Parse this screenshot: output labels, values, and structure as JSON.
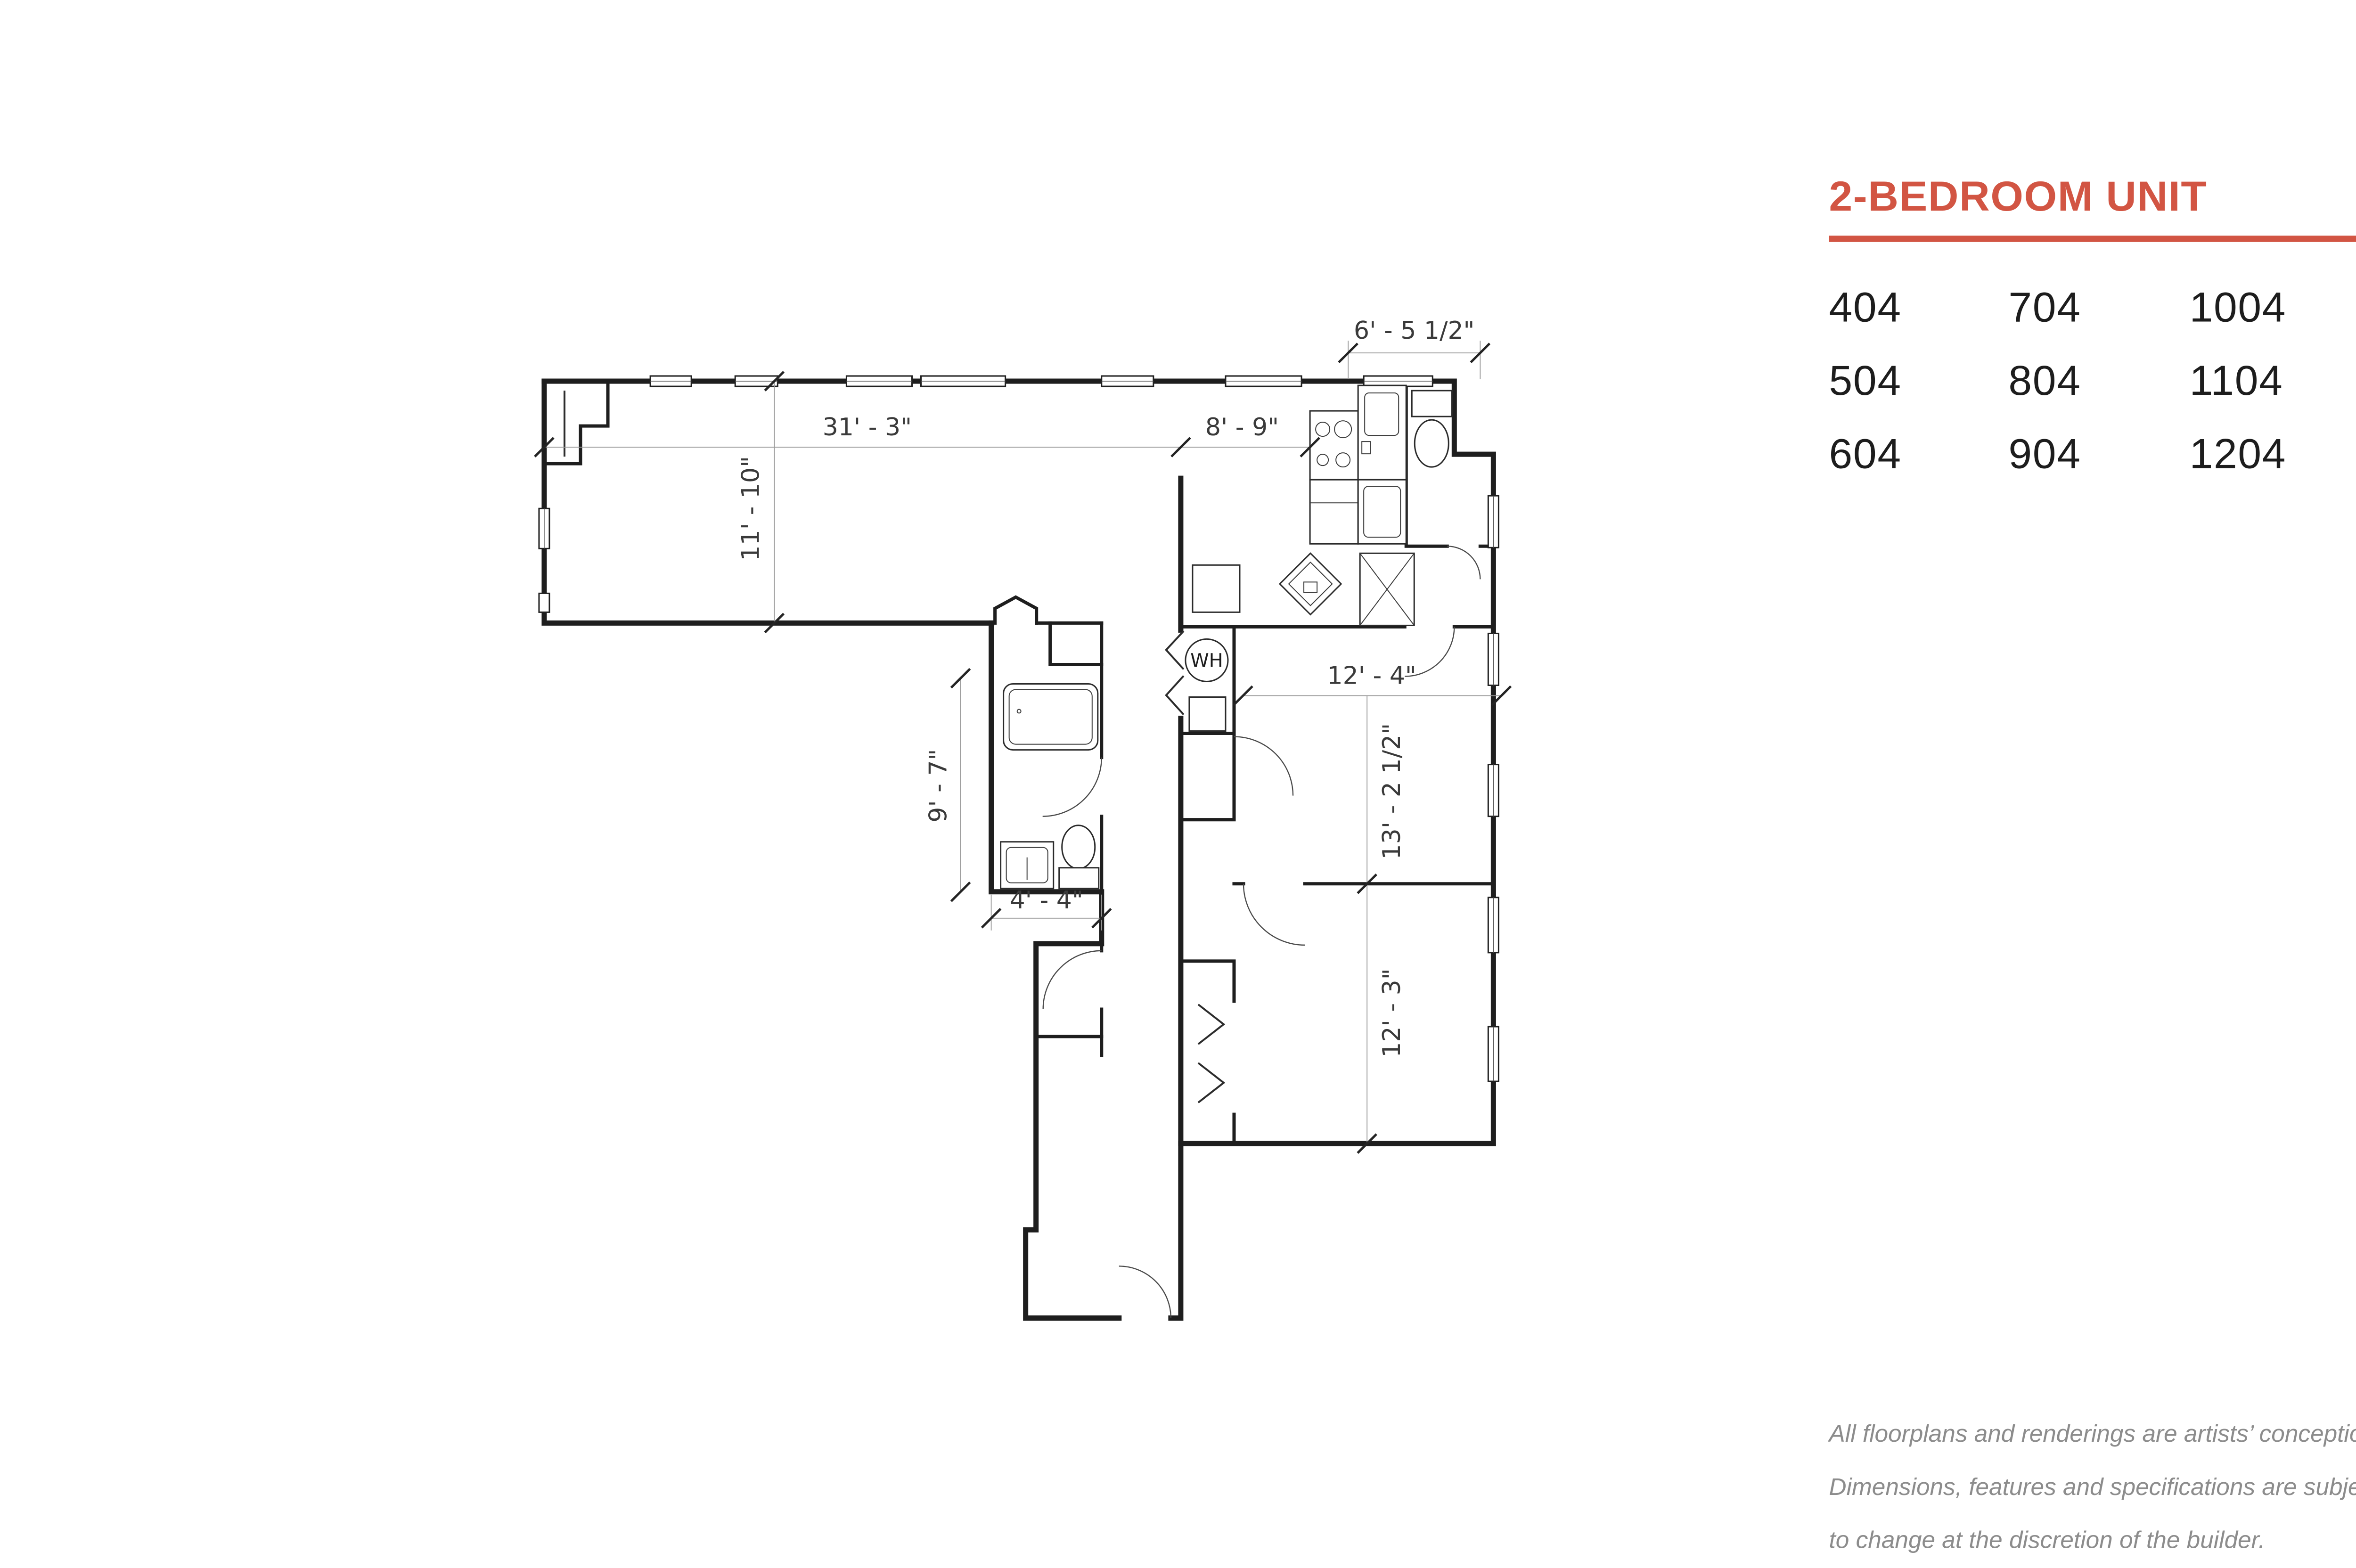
{
  "theme": {
    "accent_color": "#d25543",
    "wall_color": "#1e1e1e",
    "dim_text_color": "#3a3a3a",
    "disclaimer_color": "#8c8c8c"
  },
  "header": {
    "title": "2-BEDROOM UNIT"
  },
  "units": {
    "cells": [
      "404",
      "704",
      "1004",
      "504",
      "804",
      "1104",
      "604",
      "904",
      "1204"
    ]
  },
  "floorplan": {
    "labels": {
      "living_width": "31' - 3\"",
      "kitchen_width": "8' - 9\"",
      "nook_width": "6' - 5 1/2\"",
      "living_depth": "11' - 10\"",
      "bedroom1_width": "12' - 4\"",
      "bedroom1_depth": "13' - 2 1/2\"",
      "bath_depth": "9' - 7\"",
      "bath_width": "4' - 4\"",
      "bedroom2_depth": "12' - 3\"",
      "water_heater": "WH"
    }
  },
  "disclaimer": {
    "lines": [
      "All floorplans and renderings are artists’ conception.",
      "Dimensions, features and specifications are subject",
      "to change at the discretion of the builder."
    ]
  }
}
